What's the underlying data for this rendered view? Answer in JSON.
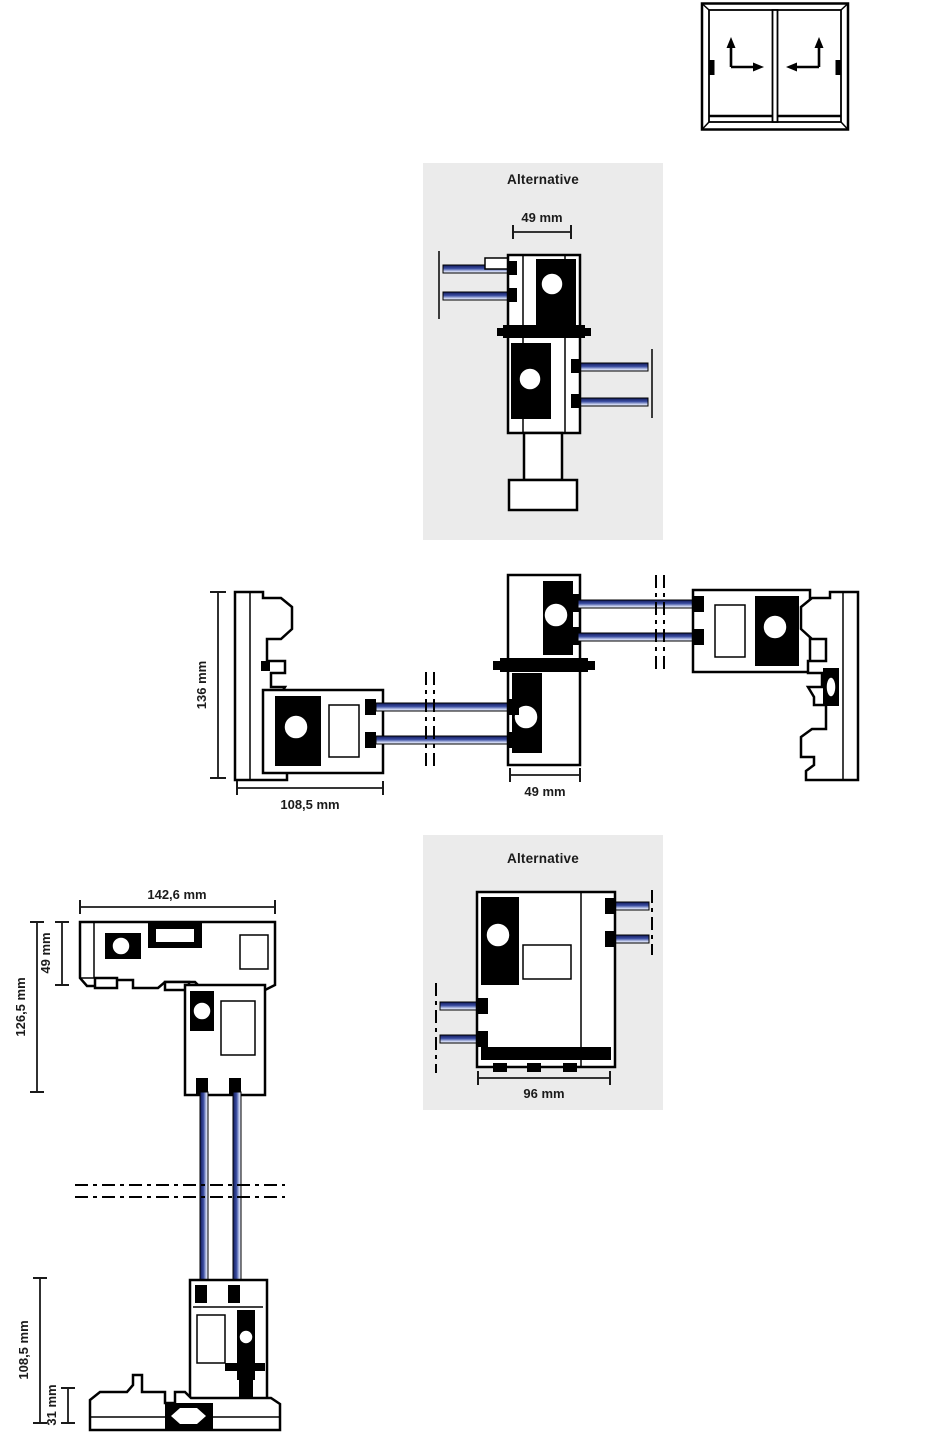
{
  "drawing": {
    "icon": {
      "name": "sliding-window-elevation",
      "sashes": 2,
      "description": "two-sash lift-slide window front view with slide direction arrows"
    },
    "alternative_top": {
      "title": "Alternative",
      "dim_interlock_width": "49 mm"
    },
    "horizontal_section": {
      "dim_frame_depth": "136 mm",
      "dim_frame_width": "108,5 mm",
      "dim_interlock_width": "49 mm"
    },
    "alternative_bottom": {
      "title": "Alternative",
      "dim_profile_width": "96 mm"
    },
    "vertical_section": {
      "dim_head_width": "142,6 mm",
      "dim_sash_height": "49 mm",
      "dim_head_height": "126,5 mm",
      "dim_bottom_height": "108,5 mm",
      "dim_track_height": "31 mm"
    },
    "colors": {
      "panel_background": "#ebebeb",
      "profile_line": "#000000",
      "glass_dark": "#10195a",
      "glass_mid": "#3c4fa3",
      "glass_light": "#eef1fb",
      "text": "#1b1b1b"
    }
  }
}
